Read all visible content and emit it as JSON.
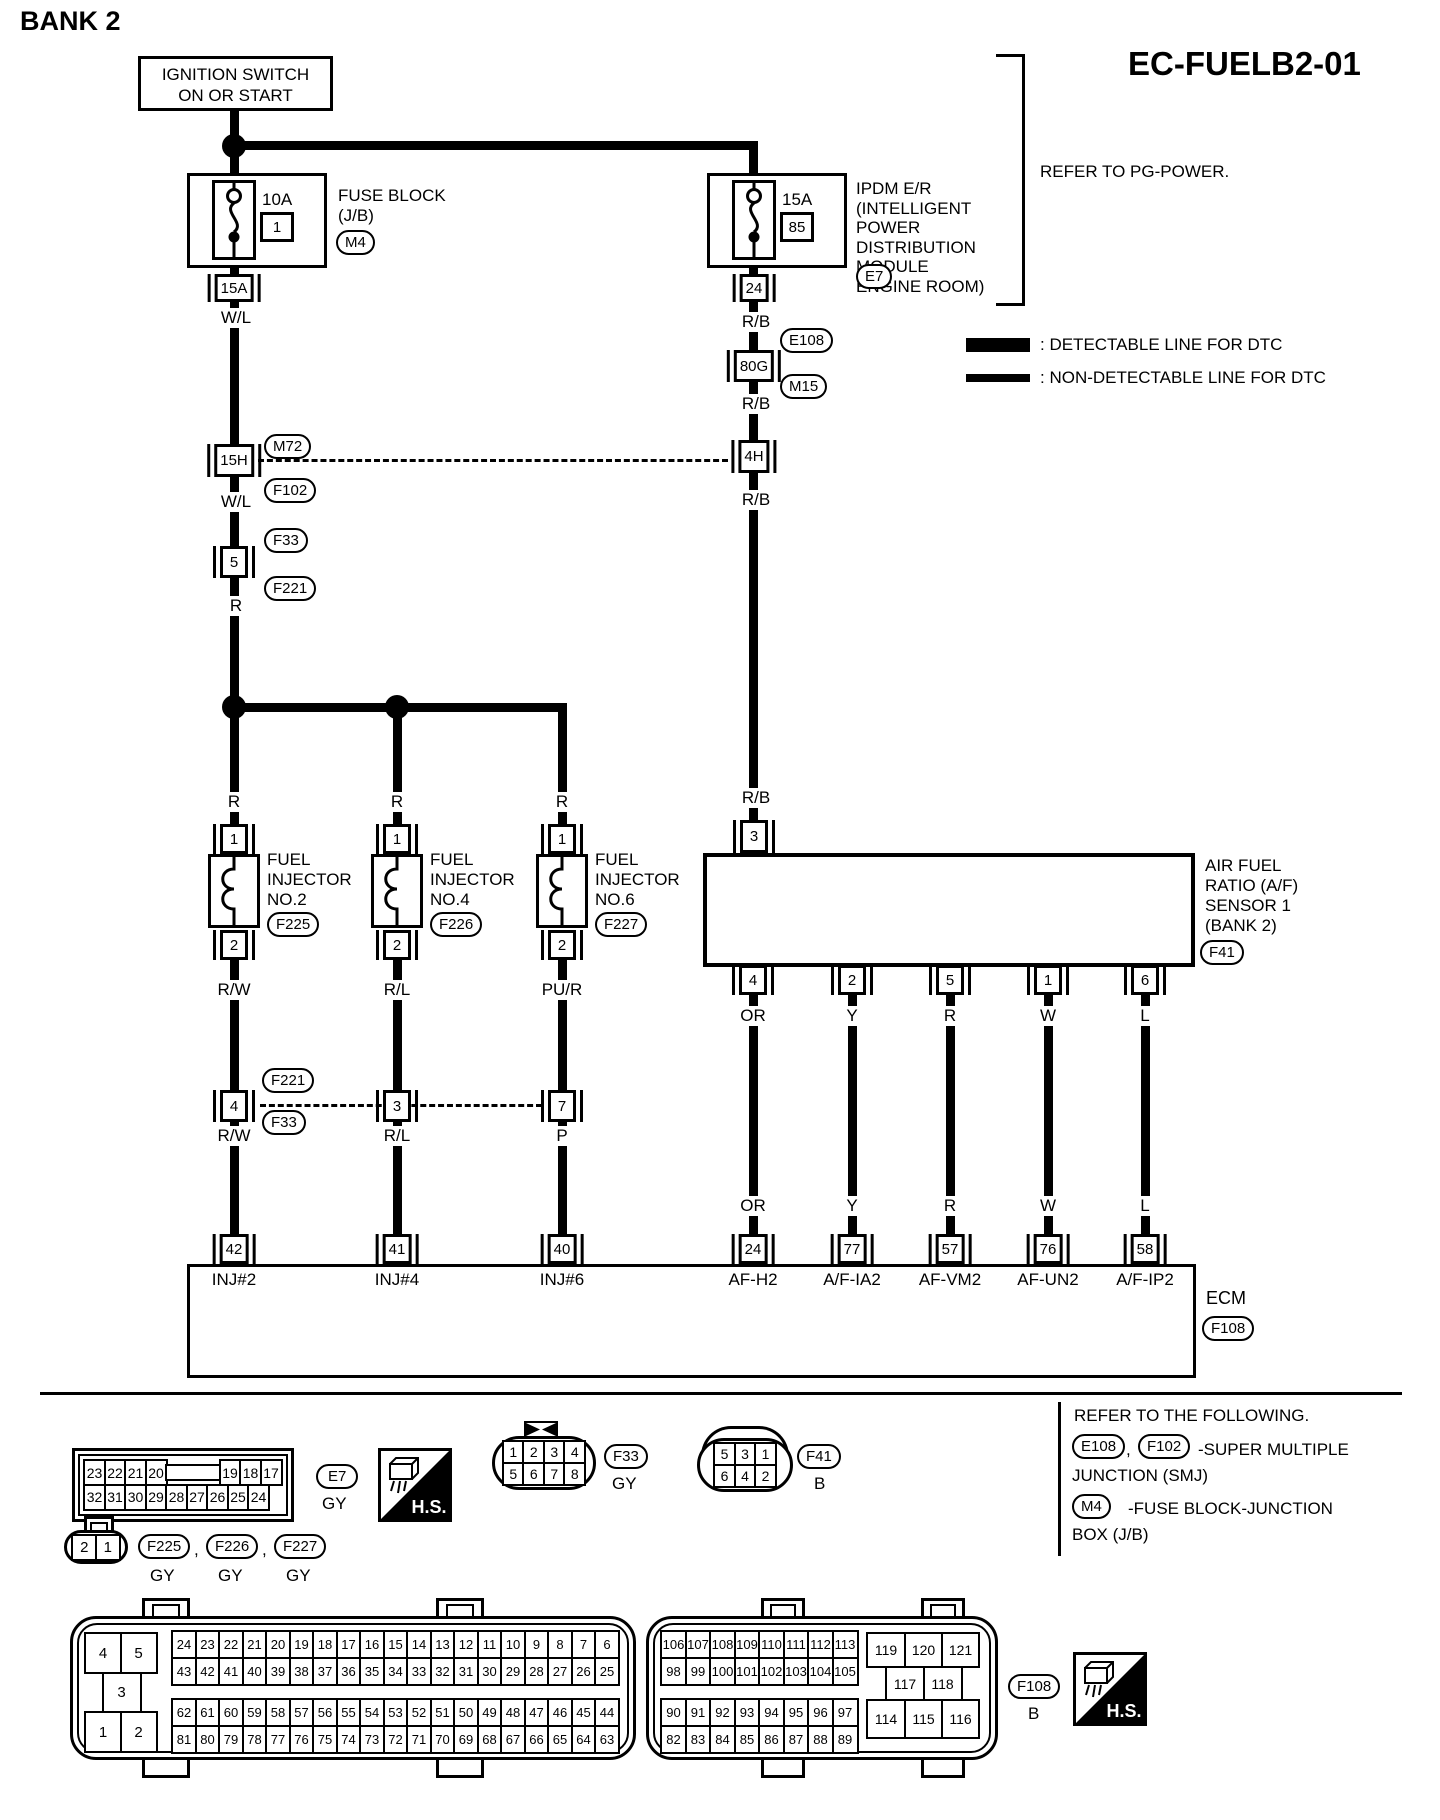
{
  "header": {
    "title": "BANK 2",
    "code": "EC-FUELB2-01"
  },
  "legend": {
    "detectable": ": DETECTABLE LINE FOR DTC",
    "non_detectable": ": NON-DETECTABLE LINE FOR DTC"
  },
  "refer_power": "REFER TO PG-POWER.",
  "ignition": {
    "line1": "IGNITION SWITCH",
    "line2": "ON OR START"
  },
  "fuse_block": {
    "amp": "10A",
    "fuse_no": "1",
    "name1": "FUSE BLOCK",
    "name2": "(J/B)",
    "conn": "M4",
    "pin": "15A"
  },
  "ipdm": {
    "amp": "15A",
    "fuse_no": "85",
    "name": [
      "IPDM E/R",
      "(INTELLIGENT",
      "POWER",
      "DISTRIBUTION",
      "MODULE",
      "ENGINE ROOM)"
    ],
    "conn": "E7",
    "pin": "24"
  },
  "left_chain": {
    "wire1": "W/L",
    "pin_15h": "15H",
    "conn_m72": "M72",
    "conn_f102": "F102",
    "wire2": "W/L",
    "conn_f33": "F33",
    "pin_5": "5",
    "conn_f221": "F221",
    "wire3": "R"
  },
  "right_chain": {
    "wire1": "R/B",
    "conn_e108": "E108",
    "pin_80g": "80G",
    "conn_m15": "M15",
    "wire2": "R/B",
    "pin_4h": "4H",
    "wire3": "R/B",
    "wire4": "R/B"
  },
  "mid_conns": {
    "above": "F221",
    "below": "F33"
  },
  "injectors": [
    {
      "branch_wire": "R",
      "pin_top": "1",
      "pin_bot": "2",
      "lines": [
        "FUEL",
        "INJECTOR",
        "NO.2"
      ],
      "conn": "F225",
      "wire_a": "R/W",
      "mid_pin": "4",
      "wire_b": "R/W",
      "ecm_pin": "42",
      "ecm_label": "INJ#2"
    },
    {
      "branch_wire": "R",
      "pin_top": "1",
      "pin_bot": "2",
      "lines": [
        "FUEL",
        "INJECTOR",
        "NO.4"
      ],
      "conn": "F226",
      "wire_a": "R/L",
      "mid_pin": "3",
      "wire_b": "R/L",
      "ecm_pin": "41",
      "ecm_label": "INJ#4"
    },
    {
      "branch_wire": "R",
      "pin_top": "1",
      "pin_bot": "2",
      "lines": [
        "FUEL",
        "INJECTOR",
        "NO.6"
      ],
      "conn": "F227",
      "wire_a": "PU/R",
      "mid_pin": "7",
      "wire_b": "P",
      "ecm_pin": "40",
      "ecm_label": "INJ#6"
    }
  ],
  "af_sensor": {
    "wire_in": "R/B",
    "pin_top": "3",
    "lines": [
      "AIR FUEL",
      "RATIO (A/F)",
      "SENSOR 1",
      "(BANK 2)"
    ],
    "conn": "F41",
    "channels": [
      {
        "pin": "4",
        "wire": "OR",
        "wire2": "OR",
        "ecm_pin": "24",
        "ecm_label": "AF-H2"
      },
      {
        "pin": "2",
        "wire": "Y",
        "wire2": "Y",
        "ecm_pin": "77",
        "ecm_label": "A/F-IA2"
      },
      {
        "pin": "5",
        "wire": "R",
        "wire2": "R",
        "ecm_pin": "57",
        "ecm_label": "AF-VM2"
      },
      {
        "pin": "1",
        "wire": "W",
        "wire2": "W",
        "ecm_pin": "76",
        "ecm_label": "AF-UN2"
      },
      {
        "pin": "6",
        "wire": "L",
        "wire2": "L",
        "ecm_pin": "58",
        "ecm_label": "A/F-IP2"
      }
    ]
  },
  "ecm": {
    "name": "ECM",
    "conn": "F108"
  },
  "refer_following": {
    "title": "REFER TO THE FOLLOWING.",
    "e108": "E108",
    "comma": ",",
    "f102": "F102",
    "smj1": "-SUPER MULTIPLE",
    "smj2": "JUNCTION (SMJ)",
    "m4": "M4",
    "jb1": "-FUSE BLOCK-JUNCTION",
    "jb2": "BOX (J/B)"
  },
  "footer": {
    "hs": "H.S.",
    "e7": {
      "rows": [
        [
          "23",
          "22",
          "21",
          "20",
          "",
          "19",
          "18",
          "17"
        ],
        [
          "32",
          "31",
          "30",
          "29",
          "28",
          "27",
          "26",
          "25",
          "24"
        ]
      ],
      "label": "E7",
      "color": "GY"
    },
    "f33": {
      "rows": [
        [
          "1",
          "2",
          "3",
          "4"
        ],
        [
          "5",
          "6",
          "7",
          "8"
        ]
      ],
      "label": "F33",
      "color": "GY"
    },
    "f41": {
      "rows": [
        [
          "5",
          "3",
          "1"
        ],
        [
          "6",
          "4",
          "2"
        ]
      ],
      "label": "F41",
      "color": "B"
    },
    "inj_conn": {
      "rows": [
        [
          "2",
          "1"
        ]
      ],
      "comma1": ",",
      "comma2": ",",
      "labels": [
        {
          "id": "F225",
          "color": "GY"
        },
        {
          "id": "F226",
          "color": "GY"
        },
        {
          "id": "F227",
          "color": "GY"
        }
      ]
    },
    "ecm_conn": {
      "small_pins": {
        "p4": "4",
        "p5": "5",
        "p3": "3",
        "p1": "1",
        "p2": "2"
      },
      "grid_ul": [
        [
          "24",
          "23",
          "22",
          "21",
          "20",
          "19",
          "18",
          "17",
          "16",
          "15",
          "14",
          "13",
          "12",
          "11",
          "10",
          "9",
          "8",
          "7",
          "6"
        ],
        [
          "43",
          "42",
          "41",
          "40",
          "39",
          "38",
          "37",
          "36",
          "35",
          "34",
          "33",
          "32",
          "31",
          "30",
          "29",
          "28",
          "27",
          "26",
          "25"
        ]
      ],
      "grid_ll": [
        [
          "62",
          "61",
          "60",
          "59",
          "58",
          "57",
          "56",
          "55",
          "54",
          "53",
          "52",
          "51",
          "50",
          "49",
          "48",
          "47",
          "46",
          "45",
          "44"
        ],
        [
          "81",
          "80",
          "79",
          "78",
          "77",
          "76",
          "75",
          "74",
          "73",
          "72",
          "71",
          "70",
          "69",
          "68",
          "67",
          "66",
          "65",
          "64",
          "63"
        ]
      ],
      "grid_ur": [
        [
          "106",
          "107",
          "108",
          "109",
          "110",
          "111",
          "112",
          "113"
        ],
        [
          "98",
          "99",
          "100",
          "101",
          "102",
          "103",
          "104",
          "105"
        ]
      ],
      "grid_lr": [
        [
          "90",
          "91",
          "92",
          "93",
          "94",
          "95",
          "96",
          "97"
        ],
        [
          "82",
          "83",
          "84",
          "85",
          "86",
          "87",
          "88",
          "89"
        ]
      ],
      "large_pins": {
        "r1": [
          "119",
          "120",
          "121"
        ],
        "r2": [
          "117",
          "118"
        ],
        "r3": [
          "114",
          "115",
          "116"
        ]
      },
      "label": "F108",
      "color": "B"
    }
  },
  "colors": {
    "line": "#000000",
    "bg": "#ffffff"
  }
}
